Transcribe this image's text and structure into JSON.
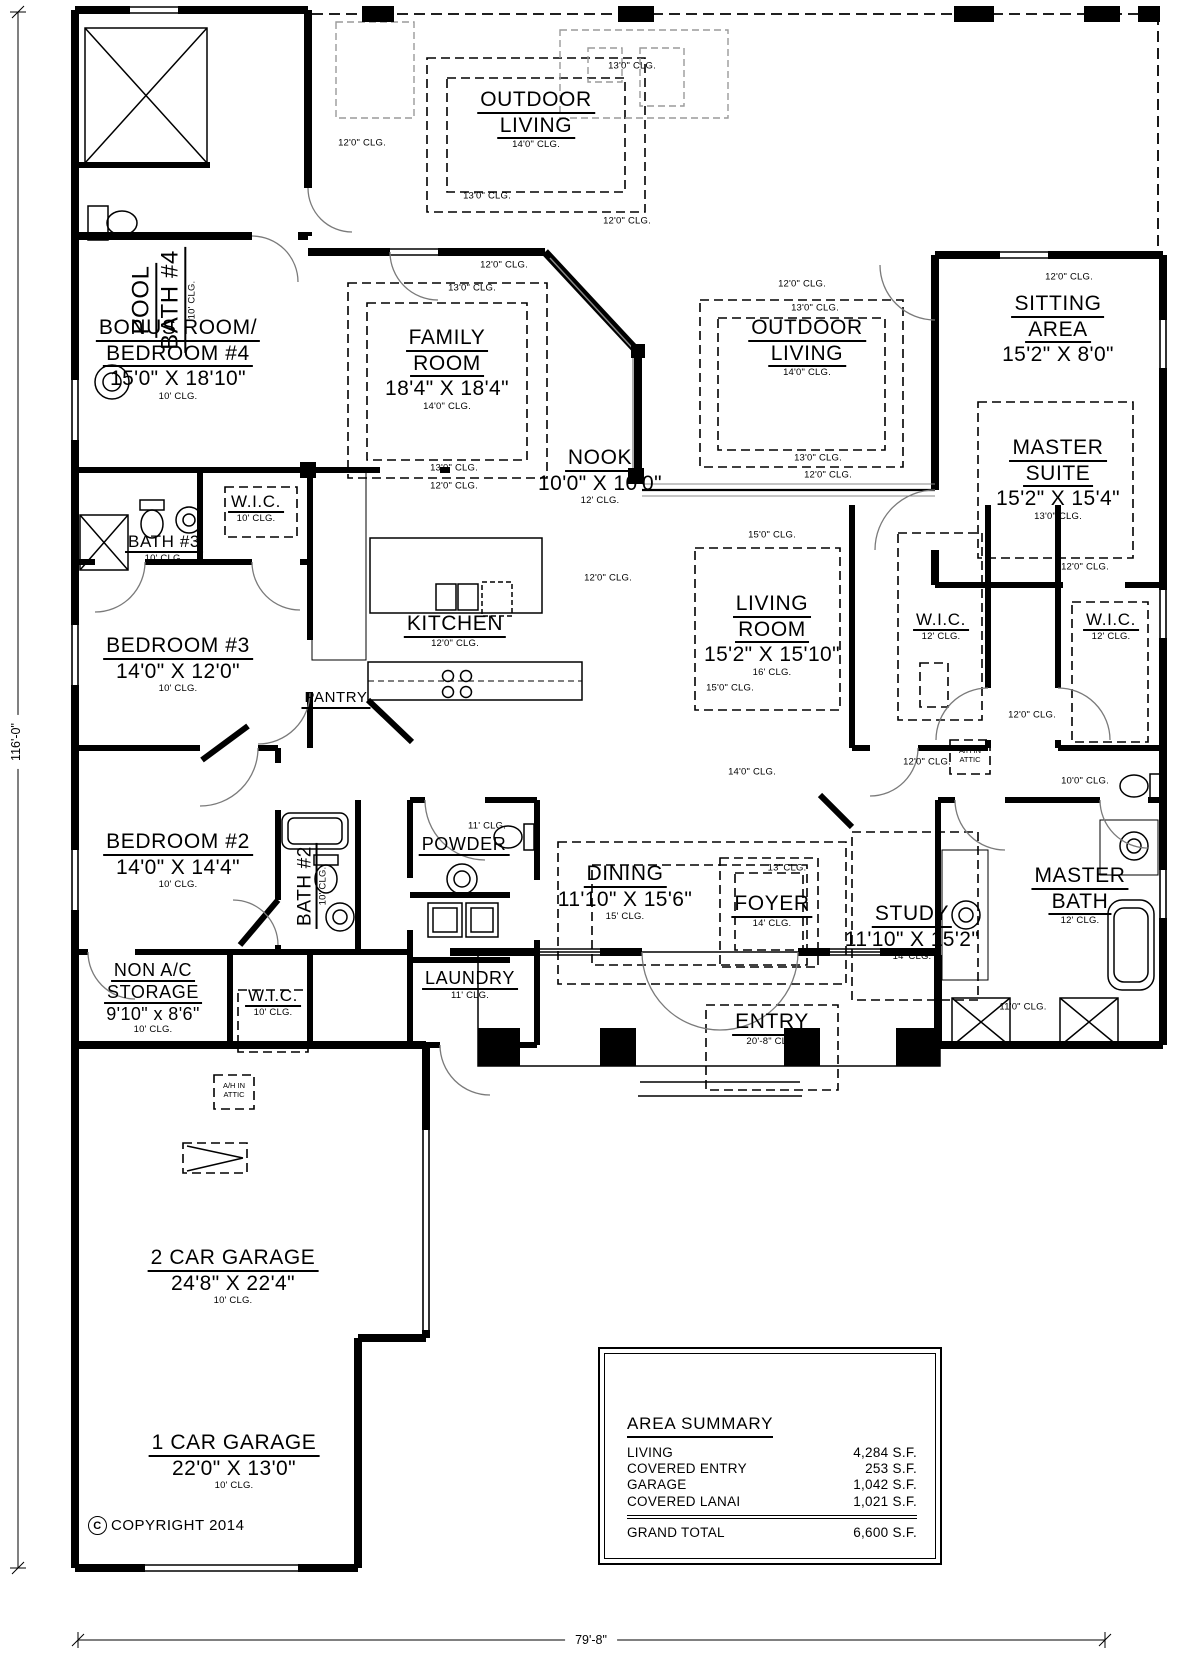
{
  "plan": {
    "copyright_symbol": "C",
    "copyright": "COPYRIGHT 2014",
    "overall_depth": "116'-0\"",
    "overall_width": "79'-8\""
  },
  "rooms": [
    {
      "id": "pool-bath",
      "lines": [
        "POOL",
        "BATH #4"
      ],
      "clg": "10' CLG.",
      "x": 163,
      "y": 300,
      "rot": true,
      "fs": 24
    },
    {
      "id": "outdoor-living-north",
      "lines": [
        "OUTDOOR",
        "LIVING"
      ],
      "clg": "14'0\" CLG.",
      "x": 536,
      "y": 88,
      "fs": 21
    },
    {
      "id": "bonus-room",
      "lines": [
        "BONUS ROOM/",
        "BEDROOM #4"
      ],
      "dims": "15'0\" X 18'10\"",
      "clg": "10' CLG.",
      "x": 178,
      "y": 316,
      "fs": 21
    },
    {
      "id": "family-room",
      "lines": [
        "FAMILY",
        "ROOM"
      ],
      "dims": "18'4\" X 18'4\"",
      "clg": "14'0\" CLG.",
      "x": 447,
      "y": 326,
      "fs": 21
    },
    {
      "id": "nook",
      "lines": [
        "NOOK"
      ],
      "dims": "10'0\" X 10'0\"",
      "clg": "12' CLG.",
      "x": 600,
      "y": 446,
      "fs": 21
    },
    {
      "id": "outdoor-living-east",
      "lines": [
        "OUTDOOR",
        "LIVING"
      ],
      "clg": "14'0\" CLG.",
      "x": 807,
      "y": 316,
      "fs": 21
    },
    {
      "id": "sitting-area",
      "lines": [
        "SITTING",
        "AREA"
      ],
      "dims": "15'2\" X 8'0\"",
      "x": 1058,
      "y": 292,
      "fs": 21
    },
    {
      "id": "master-suite",
      "lines": [
        "MASTER",
        "SUITE"
      ],
      "dims": "15'2\" X 15'4\"",
      "clg": "13'0\" CLG.",
      "x": 1058,
      "y": 436,
      "fs": 21
    },
    {
      "id": "kitchen",
      "lines": [
        "KITCHEN"
      ],
      "clg": "12'0\" CLG.",
      "x": 455,
      "y": 612,
      "fs": 21
    },
    {
      "id": "pantry",
      "lines": [
        "PANTRY"
      ],
      "x": 336,
      "y": 690,
      "fs": 15
    },
    {
      "id": "bath-3",
      "lines": [
        "BATH #3"
      ],
      "clg": "10' CLG.",
      "x": 164,
      "y": 532,
      "fs": 17
    },
    {
      "id": "wic-bed34",
      "lines": [
        "W.I.C."
      ],
      "clg": "10' CLG.",
      "x": 256,
      "y": 492,
      "fs": 17
    },
    {
      "id": "bedroom-3",
      "lines": [
        "BEDROOM #3"
      ],
      "dims": "14'0\" X 12'0\"",
      "clg": "10' CLG.",
      "x": 178,
      "y": 634,
      "fs": 21
    },
    {
      "id": "living-room",
      "lines": [
        "LIVING",
        "ROOM"
      ],
      "dims": "15'2\" X 15'10\"",
      "clg": "16' CLG.",
      "x": 772,
      "y": 592,
      "fs": 21
    },
    {
      "id": "wic-master-1",
      "lines": [
        "W.I.C."
      ],
      "clg": "12' CLG.",
      "x": 941,
      "y": 610,
      "fs": 17
    },
    {
      "id": "wic-master-2",
      "lines": [
        "W.I.C."
      ],
      "clg": "12' CLG.",
      "x": 1111,
      "y": 610,
      "fs": 17
    },
    {
      "id": "bedroom-2",
      "lines": [
        "BEDROOM #2"
      ],
      "dims": "14'0\" X 14'4\"",
      "clg": "10' CLG.",
      "x": 178,
      "y": 830,
      "fs": 21
    },
    {
      "id": "bath-2",
      "lines": [
        "BATH #2"
      ],
      "clg": "10' CLG.",
      "x": 312,
      "y": 886,
      "rot": true,
      "fs": 19
    },
    {
      "id": "storage",
      "lines": [
        "NON A/C",
        "STORAGE"
      ],
      "dims": "9'10\" x 8'6\"",
      "clg": "10' CLG.",
      "x": 153,
      "y": 960,
      "fs": 18
    },
    {
      "id": "wic-bed2",
      "lines": [
        "W.I.C."
      ],
      "clg": "10' CLG.",
      "x": 273,
      "y": 986,
      "fs": 17
    },
    {
      "id": "powder",
      "lines": [
        "POWDER"
      ],
      "x": 464,
      "y": 834,
      "fs": 18
    },
    {
      "id": "laundry",
      "lines": [
        "LAUNDRY"
      ],
      "clg": "11' CLG.",
      "x": 470,
      "y": 968,
      "fs": 18
    },
    {
      "id": "dining",
      "lines": [
        "DINING"
      ],
      "dims": "11'10\" X 15'6\"",
      "clg": "15' CLG.",
      "x": 625,
      "y": 862,
      "fs": 21
    },
    {
      "id": "foyer",
      "lines": [
        "FOYER"
      ],
      "clg": "14' CLG.",
      "x": 772,
      "y": 892,
      "fs": 21
    },
    {
      "id": "study",
      "lines": [
        "STUDY"
      ],
      "dims": "11'10\" X 15'2\"",
      "clg": "14' CLG.",
      "x": 912,
      "y": 902,
      "fs": 21
    },
    {
      "id": "master-bath",
      "lines": [
        "MASTER",
        "BATH"
      ],
      "clg": "12' CLG.",
      "x": 1080,
      "y": 864,
      "fs": 21
    },
    {
      "id": "entry",
      "lines": [
        "ENTRY"
      ],
      "clg": "20'-8\" CLG.",
      "x": 772,
      "y": 1010,
      "fs": 21
    },
    {
      "id": "garage-2car",
      "lines": [
        "2 CAR GARAGE"
      ],
      "dims": "24'8\" X 22'4\"",
      "clg": "10' CLG.",
      "x": 233,
      "y": 1246,
      "fs": 21
    },
    {
      "id": "garage-1car",
      "lines": [
        "1 CAR GARAGE"
      ],
      "dims": "22'0\" X 13'0\"",
      "clg": "10' CLG.",
      "x": 234,
      "y": 1431,
      "fs": 21
    }
  ],
  "ceiling_labels": [
    {
      "text": "12'0\" CLG.",
      "x": 362,
      "y": 143
    },
    {
      "text": "13'0\" CLG.",
      "x": 632,
      "y": 66
    },
    {
      "text": "13'0\" CLG.",
      "x": 487,
      "y": 196
    },
    {
      "text": "12'0\" CLG.",
      "x": 627,
      "y": 221
    },
    {
      "text": "12'0\" CLG.",
      "x": 504,
      "y": 265
    },
    {
      "text": "13'0\" CLG.",
      "x": 472,
      "y": 288
    },
    {
      "text": "13'0\" CLG.",
      "x": 454,
      "y": 468
    },
    {
      "text": "12'0\" CLG.",
      "x": 454,
      "y": 486
    },
    {
      "text": "12'0\" CLG.",
      "x": 802,
      "y": 284
    },
    {
      "text": "13'0\" CLG.",
      "x": 815,
      "y": 308
    },
    {
      "text": "13'0\" CLG.",
      "x": 818,
      "y": 458
    },
    {
      "text": "12'0\" CLG.",
      "x": 828,
      "y": 475
    },
    {
      "text": "12'0\" CLG.",
      "x": 1069,
      "y": 277
    },
    {
      "text": "15'0\" CLG.",
      "x": 772,
      "y": 535
    },
    {
      "text": "12'0\" CLG.",
      "x": 608,
      "y": 578
    },
    {
      "text": "15'0\" CLG.",
      "x": 730,
      "y": 688
    },
    {
      "text": "12'0\" CLG.",
      "x": 1085,
      "y": 567
    },
    {
      "text": "12'0\" CLG.",
      "x": 1032,
      "y": 715
    },
    {
      "text": "12'0\" CLG.",
      "x": 927,
      "y": 762
    },
    {
      "text": "14'0\" CLG.",
      "x": 752,
      "y": 772
    },
    {
      "text": "10'0\" CLG.",
      "x": 1085,
      "y": 781
    },
    {
      "text": "13' CLG.",
      "x": 787,
      "y": 868
    },
    {
      "text": "11' CLG.",
      "x": 487,
      "y": 826
    },
    {
      "text": "11'0\" CLG.",
      "x": 1023,
      "y": 1007
    }
  ],
  "equipment_labels": [
    {
      "lines": [
        "A/H IN",
        "ATTIC"
      ],
      "x": 234,
      "y": 1081
    },
    {
      "lines": [
        "A/H IN",
        "ATTIC"
      ],
      "x": 970,
      "y": 746
    }
  ],
  "area_summary": {
    "title": "AREA SUMMARY",
    "rows": [
      {
        "label": "LIVING",
        "value": "4,284 S.F."
      },
      {
        "label": "COVERED ENTRY",
        "value": "253 S.F."
      },
      {
        "label": "GARAGE",
        "value": "1,042 S.F."
      },
      {
        "label": "COVERED LANAI",
        "value": "1,021 S.F."
      }
    ],
    "total": {
      "label": "GRAND TOTAL",
      "value": "6,600 S.F."
    }
  }
}
